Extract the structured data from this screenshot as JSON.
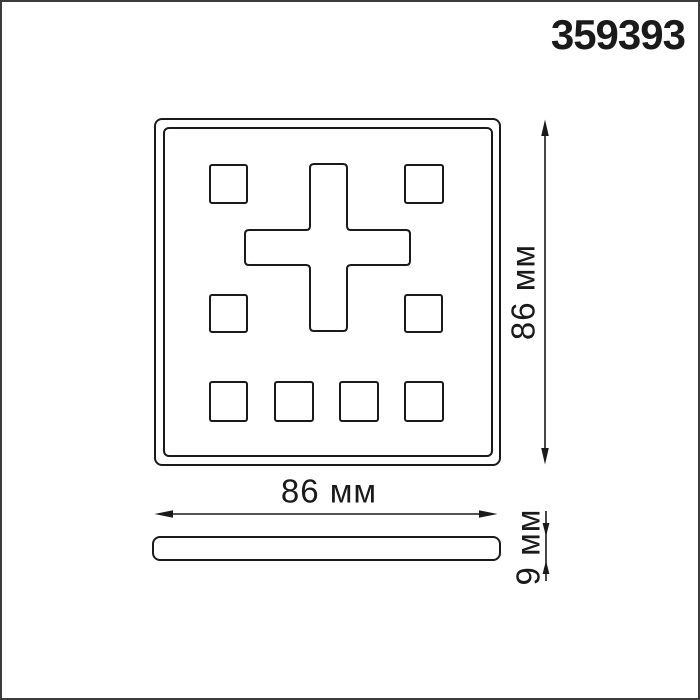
{
  "product_code": "359393",
  "drawing": {
    "front_view": {
      "width_label": "86 мм",
      "height_label": "86 мм",
      "cutouts": {
        "small_squares": 8,
        "center_cross": 1
      }
    },
    "side_view": {
      "thickness_label": "9 мм"
    },
    "units": "мм"
  },
  "colors": {
    "line": "#1a1a1a",
    "background": "#ffffff",
    "frame": "#3b3b3b"
  }
}
